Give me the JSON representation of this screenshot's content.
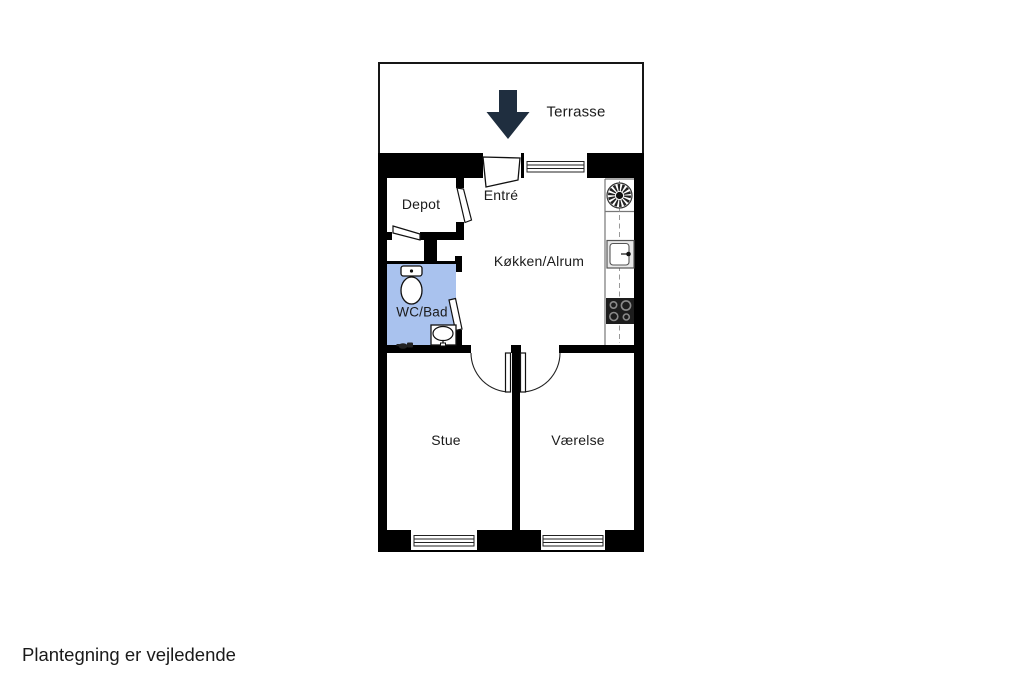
{
  "page": {
    "footer_note": "Plantegning er vejledende"
  },
  "floorplan": {
    "type": "apartment-floor-plan",
    "rooms": {
      "terrasse": {
        "label": "Terrasse"
      },
      "depot": {
        "label": "Depot"
      },
      "entre": {
        "label": "Entré"
      },
      "kokken": {
        "label": "Køkken/Alrum"
      },
      "wc": {
        "label": "WC/Bad"
      },
      "stue": {
        "label": "Stue"
      },
      "vaerelse": {
        "label": "Værelse"
      }
    },
    "icons": {
      "entrance_arrow": "entrance-arrow-icon",
      "extractor_fan": "extractor-fan-icon",
      "kitchen_sink": "kitchen-sink-icon",
      "cooktop": "cooktop-icon",
      "toilet": "toilet-icon",
      "bathroom_sink": "bathroom-sink-icon",
      "floor_drain": "floor-drain-icon"
    },
    "colors": {
      "wall": "#000000",
      "wc_fill": "#a9c2ee",
      "arrow": "#1f2e3f",
      "line": "#111111",
      "text": "#1b1b1b"
    }
  }
}
